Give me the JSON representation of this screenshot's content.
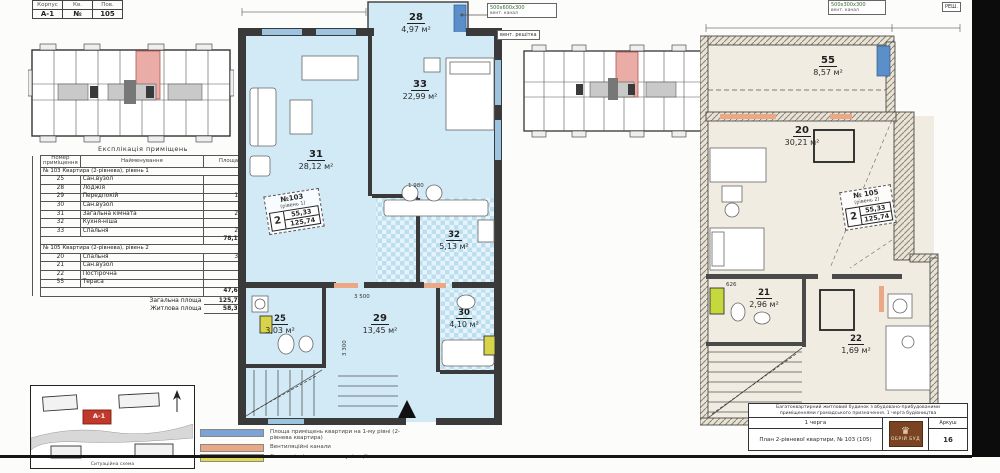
{
  "corner_table": {
    "labels": [
      "Корпус",
      "Кв.",
      "Пов."
    ],
    "values": [
      "А-1",
      "№",
      "105"
    ]
  },
  "explication": {
    "title": "Експлікація приміщень",
    "columns": [
      "Номер приміщення",
      "Найменування",
      "Площа"
    ],
    "sections": [
      {
        "header": "№ 103  Квартира (2-рівнева), рівень 1",
        "rows": [
          [
            "25",
            "Сан.вузол",
            "3,03"
          ],
          [
            "28",
            "Лоджія",
            "4,97"
          ],
          [
            "29",
            "Передпокій",
            "13,45"
          ],
          [
            "30",
            "Сан.вузол",
            "4,10"
          ],
          [
            "31",
            "Загальна кімната",
            "28,12"
          ],
          [
            "32",
            "Кухня-ніша",
            "5,13"
          ],
          [
            "33",
            "Спальня",
            "22,99"
          ]
        ],
        "subtotal": "78,13 м²"
      },
      {
        "header": "№ 105  Квартира (2-рівнева), рівень 2",
        "rows": [
          [
            "20",
            "Спальня",
            "30,21"
          ],
          [
            "21",
            "Сан.вузол",
            "2,96"
          ],
          [
            "22",
            "Постірочна",
            "1,69"
          ],
          [
            "55",
            "Тераса",
            "8,57"
          ]
        ],
        "subtotal": "47,61 м²"
      }
    ],
    "totals": [
      {
        "label": "Загальна площа",
        "value": "125,74 м²"
      },
      {
        "label": "Житлова площа",
        "value": "58,33 м²"
      }
    ]
  },
  "plan1": {
    "rooms": [
      {
        "num": "28",
        "area": "4,97 м²"
      },
      {
        "num": "31",
        "area": "28,12 м²"
      },
      {
        "num": "33",
        "area": "22,99 м²"
      },
      {
        "num": "32",
        "area": "5,13 м²"
      },
      {
        "num": "25",
        "area": "3,03 м²"
      },
      {
        "num": "29",
        "area": "13,45 м²"
      },
      {
        "num": "30",
        "area": "4,10 м²"
      }
    ],
    "badge": {
      "no": "№103",
      "level": "(рівень 1)",
      "rooms": "2",
      "living": "55,33",
      "total": "125,74"
    },
    "dims": {
      "d1": "1 980",
      "d2": "3 500",
      "d3": "3 300"
    },
    "callouts": {
      "line1": "500х600х300",
      "line2": "вент. канал",
      "box2": "вент. решітка"
    }
  },
  "plan2": {
    "rooms": [
      {
        "num": "55",
        "area": "8,57 м²"
      },
      {
        "num": "20",
        "area": "30,21 м²"
      },
      {
        "num": "21",
        "area": "2,96 м²"
      },
      {
        "num": "22",
        "area": "1,69 м²"
      }
    ],
    "badge": {
      "no": "№ 105",
      "level": "(рівень 2)",
      "rooms": "2",
      "living": "55,33",
      "total": "125,74"
    },
    "dims": {
      "d1": "626"
    },
    "callouts": {
      "line1": "500х300х300",
      "line2": "вент. канал",
      "box2": "РЕШ."
    }
  },
  "site_plan": {
    "marker": "А-1",
    "caption": "Ситуаційна схема"
  },
  "legend": {
    "items": [
      {
        "color": "#7ba3d4",
        "label": "Площа приміщень квартири на 1-му рівні (2-рівнева квартира)"
      },
      {
        "color": "#eaa884",
        "label": "Вентиляційні канали"
      },
      {
        "color": "#e0dc4c",
        "label": "Сантехнічні шахти та комунікації"
      }
    ]
  },
  "stamp": {
    "desc1": "Багатоквартирний житловий будинок з вбудовано-прибудованими",
    "desc2": "приміщеннями громадського призначення. 1 черга будівництва",
    "stage": "1 черга",
    "drawing_title": "План 2-рівневої квартири, № 103 (105)",
    "sheet_label": "Аркуш",
    "sheet_number": "16",
    "logo_text": "ОБРІЙ БУД"
  },
  "colors": {
    "room_fill_l1": "#d2eaf6",
    "room_fill_l2": "#f1ece1",
    "highlight_unit": "#e9aca6",
    "window": "#5b8fc9",
    "shaft_yellow": "#d8d44a",
    "boiler_green": "#c6d93c",
    "lintel_orange": "#eaa884"
  }
}
